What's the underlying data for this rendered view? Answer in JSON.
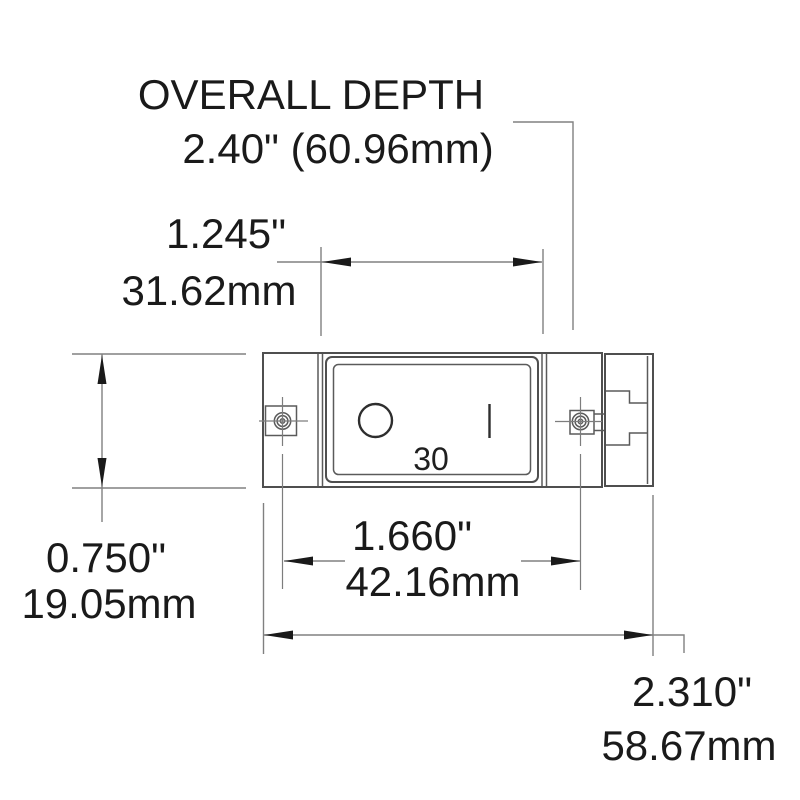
{
  "drawing": {
    "type": "technical-dimension-drawing",
    "subject": "rocker-switch-front-view",
    "overall_depth": {
      "label": "OVERALL DEPTH",
      "value": "2.40\" (60.96mm)"
    },
    "front_bezel_width": {
      "inches": "1.245\"",
      "mm": "31.62mm"
    },
    "body_height": {
      "inches": "0.750\"",
      "mm": "19.05mm"
    },
    "mounting_hole_spacing": {
      "inches": "1.660\"",
      "mm": "42.16mm"
    },
    "overall_width": {
      "inches": "2.310\"",
      "mm": "58.67mm"
    },
    "switch_face": {
      "amp_marking": "30",
      "off_symbol": "O",
      "on_symbol": "I"
    },
    "colors": {
      "outline": "#4f4f4f",
      "dimension_lines": "#808080",
      "text": "#1a1a1a",
      "background": "#ffffff"
    }
  }
}
